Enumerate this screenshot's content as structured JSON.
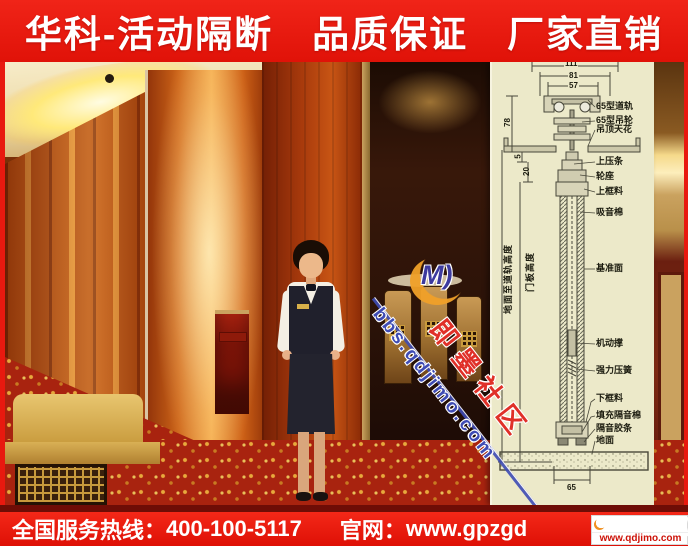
{
  "top_banner": {
    "text": "华科-活动隔断　品质保证　厂家直销"
  },
  "bottom_banner": {
    "hotline_label": "全国服务热线：",
    "phone": "400-100-5117",
    "site_label": "官网：",
    "site": "www.gpzgd"
  },
  "corner_logo": {
    "monogram": "M)",
    "name": "即墨信息港",
    "url": "www.qdjimo.com"
  },
  "watermark": {
    "monogram": "M)",
    "url": "bbs.qdjimo.com",
    "community": "即墨社区"
  },
  "diagram": {
    "labels": [
      "65型道轨",
      "65型吊轮",
      "吊顶天花",
      "上压条",
      "轮座",
      "上框料",
      "吸音棉",
      "基准面",
      "机动撑",
      "强力压簧",
      "下框料",
      "填充隔音棉",
      "隔音胶条",
      "地面"
    ],
    "vertical_labels": [
      "地面至道轨高度",
      "门板高度"
    ],
    "dims": {
      "top_outer": "111",
      "top": "81",
      "top_inner": "57",
      "left_a": "78",
      "left_b": "5",
      "left_c": "20",
      "bottom": "65"
    }
  },
  "colors": {
    "banner_red": "#e8190f",
    "diagram_bg": "#ece9c9",
    "watermark_blue": "#3f4cb4",
    "watermark_red": "#e03028",
    "logo_red": "#cc1208"
  }
}
